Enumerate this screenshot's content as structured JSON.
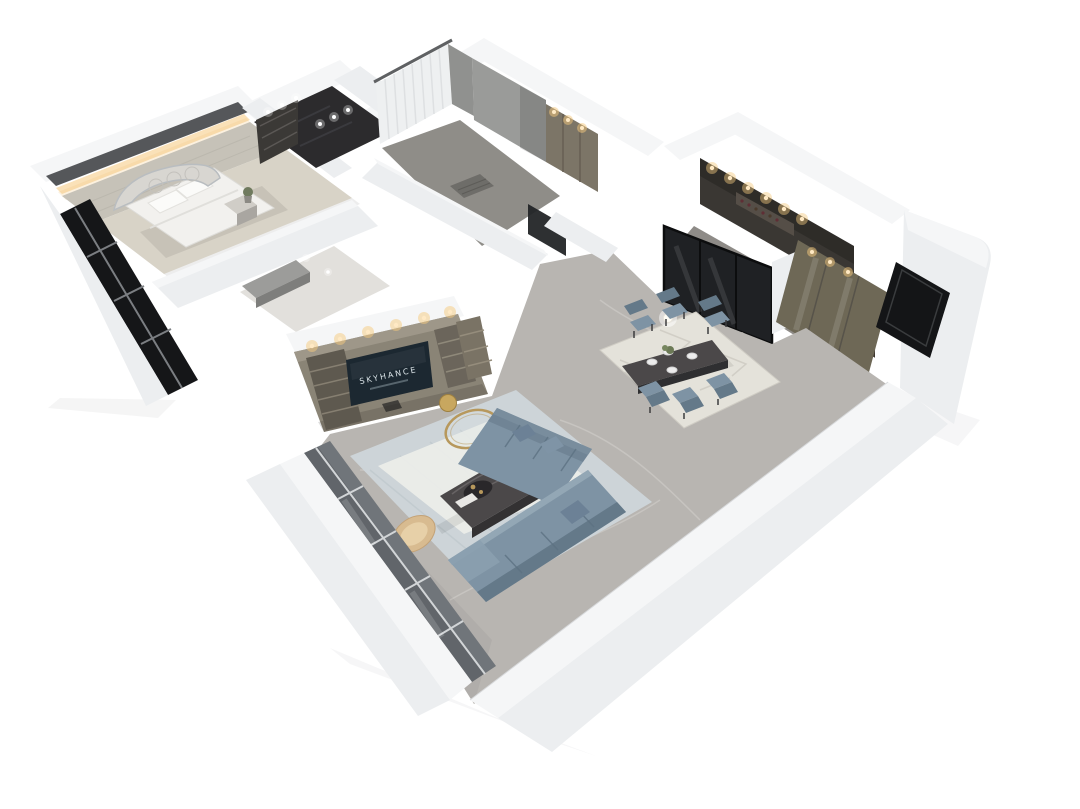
{
  "scene": {
    "description": "3D isometric cutaway (dollhouse) render of an apartment floor plan on a white background",
    "view": "axonometric from above, white exterior walls, open-plan living-dining core",
    "tv": {
      "brand_text": "SKYHANCE"
    },
    "rooms": [
      {
        "id": "master-bedroom",
        "label": "Master bedroom",
        "items": [
          "quilted-arch-headboard-bed",
          "white-duvet",
          "pillows",
          "nightstand",
          "potted-plant",
          "warm-cove-lighting",
          "dark-curtain-rail",
          "black-floor-to-ceiling-window"
        ]
      },
      {
        "id": "walk-in-closet",
        "label": "Walk-in closet",
        "items": [
          "dark-shelving-unit",
          "glossy-dark-floor",
          "recessed-downlights"
        ]
      },
      {
        "id": "second-bedroom",
        "label": "Second bedroom / dressing room",
        "items": [
          "sheer-white-curtains",
          "gray-drape",
          "gray-feature-wall",
          "wardrobe-with-downlights",
          "floor-mat",
          "black-framed-doorway"
        ]
      },
      {
        "id": "kitchen-bar",
        "label": "Kitchen / bar",
        "items": [
          "dark-upper-cabinets",
          "wine-display-shelf",
          "recessed-downlights",
          "black-framed-glass-partition",
          "bronze-glass-pane"
        ]
      },
      {
        "id": "entry-hall",
        "label": "Entry hallway",
        "items": [
          "olive-display-cabinet",
          "glass-cabinet-doors",
          "black-entry-door",
          "light-marble-floor"
        ]
      },
      {
        "id": "dining-area",
        "label": "Dining area",
        "items": [
          "dark-stone-dining-table",
          "six-upholstered-chairs",
          "white-place-settings",
          "flower-centerpiece",
          "globe-pendant-light",
          "geometric-area-rug"
        ]
      },
      {
        "id": "living-room",
        "label": "Living room",
        "items": [
          "olive-media-wall",
          "open-shelving-towers",
          "flat-screen-tv",
          "l-shaped-blue-sectional-sofa",
          "dark-marble-coffee-table",
          "gold-ring-side-table",
          "gold-stool",
          "beige-accent-chair",
          "textured-area-rug",
          "gray-marble-floor",
          "window-wall"
        ]
      }
    ]
  },
  "colors": {
    "background": "#ffffff",
    "wall_top": "#f5f6f7",
    "wall_face": "#eceef0",
    "wall_shade": "#dfe2e4",
    "rail_dark": "#55575a",
    "headboard_wall": "#c6c2b8",
    "carpet_bedroom": "#d8d3c7",
    "floor_marble": "#b8b5b1",
    "floor_marble_light": "#d6d3ce",
    "floor_dark_closet": "#2c2b2d",
    "interior_gray_wall": "#9a9b99",
    "cabinet_olive": "#6e6856",
    "tv_cabinet": "#8a8476",
    "tv_cabinet_dark": "#5e594f",
    "sofa_blue": "#7e93a4",
    "sofa_blue_dark": "#647989",
    "sofa_highlight": "#93a7b5",
    "rug_living": "#cdd4d8",
    "rug_living_inner": "#edeeea",
    "rug_dining": "#e4e2da",
    "table_dark": "#4b4849",
    "glass_black": "#1f2124",
    "window_dark": "#151618",
    "window_glass_gray": "#70757a",
    "gold": "#b7985c",
    "beige_chair": "#d8bb90",
    "tv_screen": "#1c2831",
    "tv_text": "#d9e2e6",
    "downlight_warm": "#f5c97e",
    "curtain_white": "#eef0f1",
    "drape_gray": "#90918f",
    "kitchen_cabinet_dark": "#3a3733"
  }
}
